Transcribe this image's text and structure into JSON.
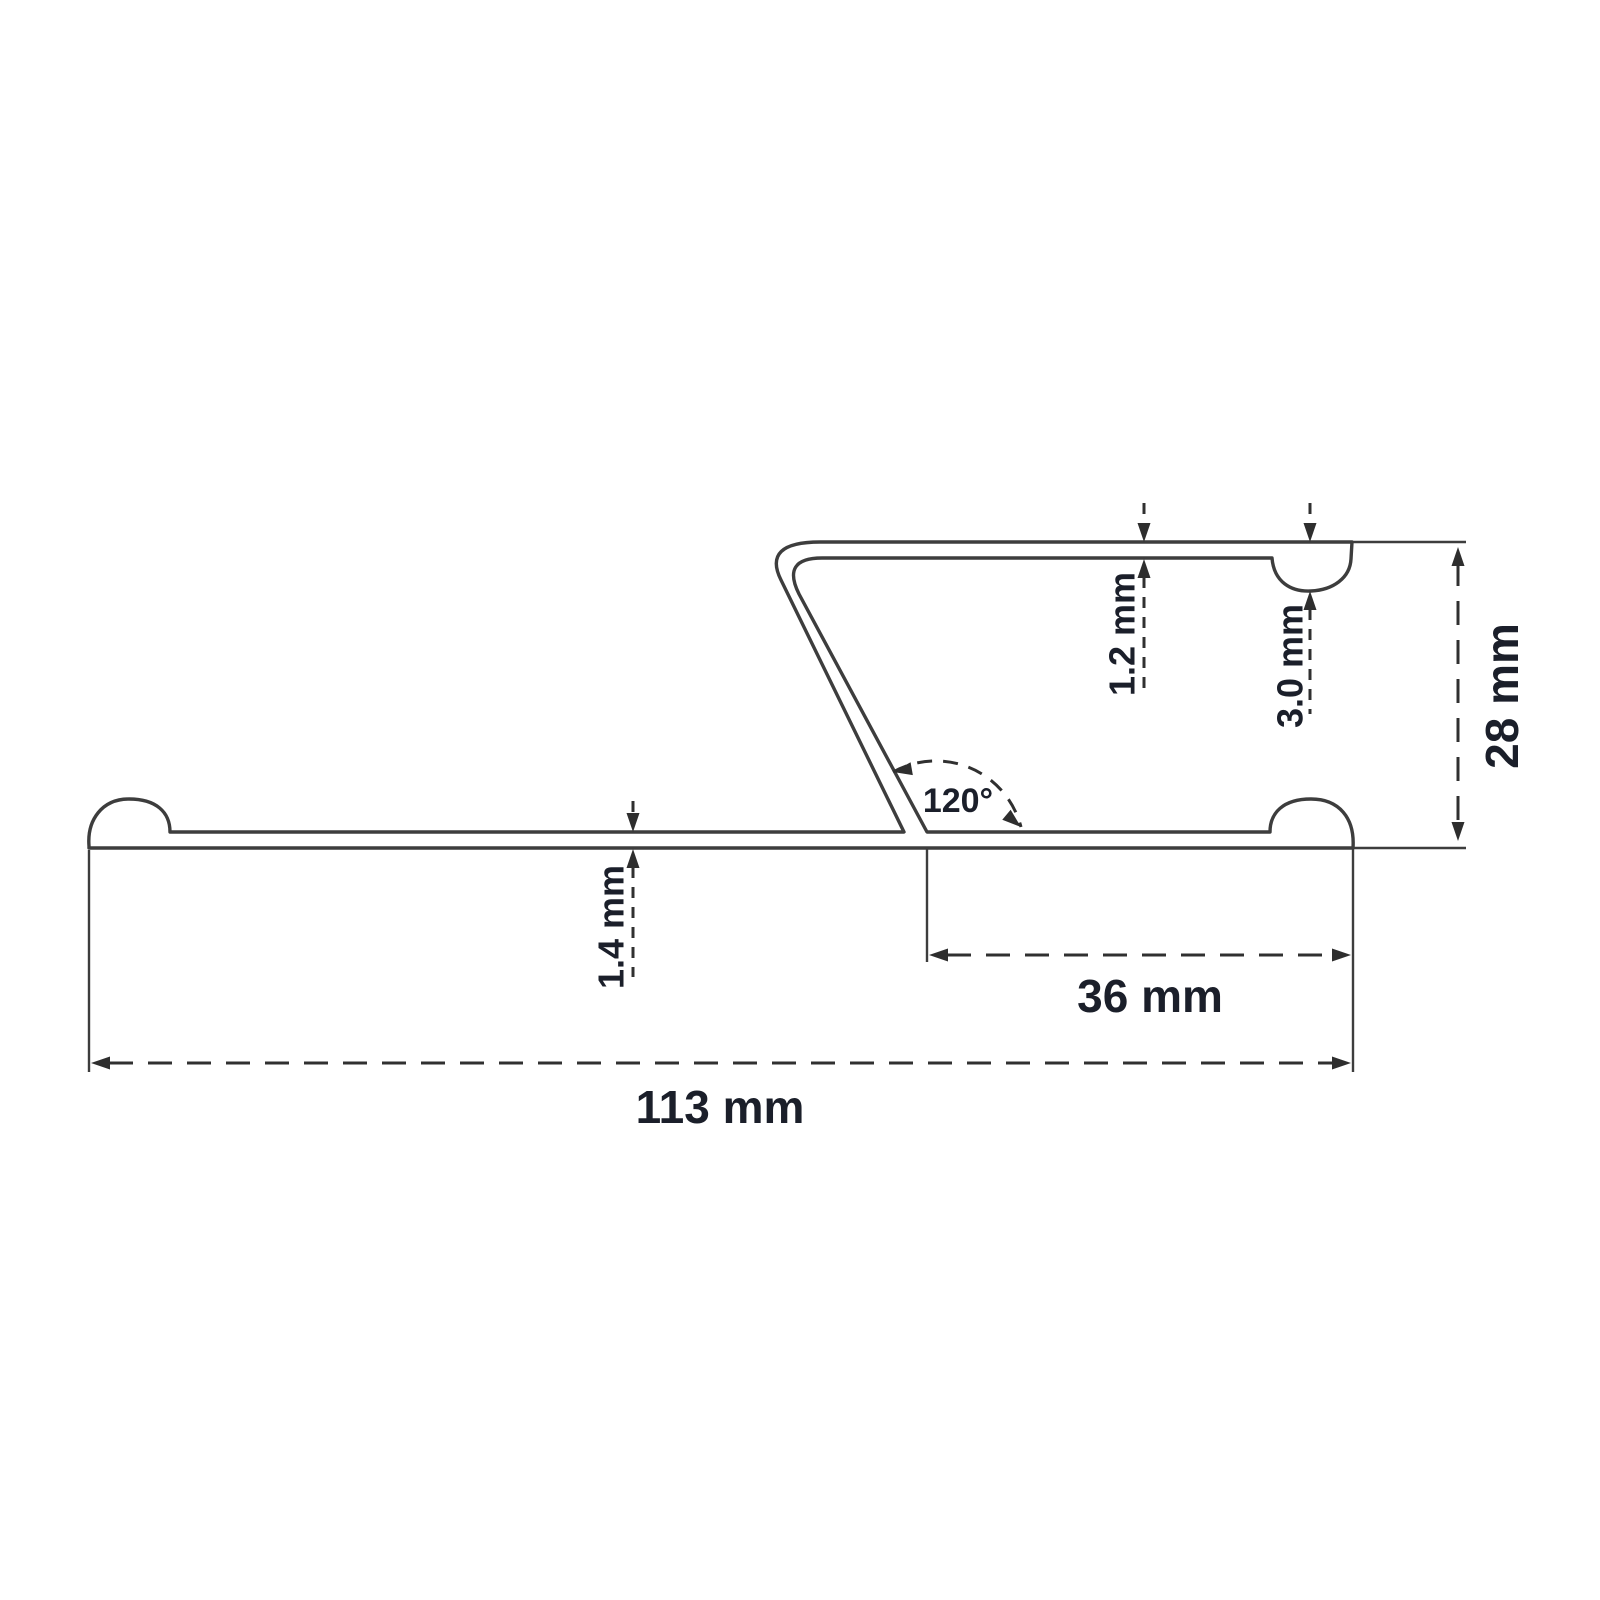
{
  "drawing": {
    "type": "profile-cross-section-technical-drawing",
    "labels": {
      "flange_thickness": "1.2 mm",
      "bead_depth": "3.0 mm",
      "overall_height": "28 mm",
      "angle": "120°",
      "base_thickness": "1.4 mm",
      "leg_offset": "36 mm",
      "overall_width": "113 mm"
    },
    "colors": {
      "line": "#3d3d3d",
      "dimension_line": "#303030",
      "label_text": "#1b1f2a",
      "background": "#ffffff"
    }
  }
}
